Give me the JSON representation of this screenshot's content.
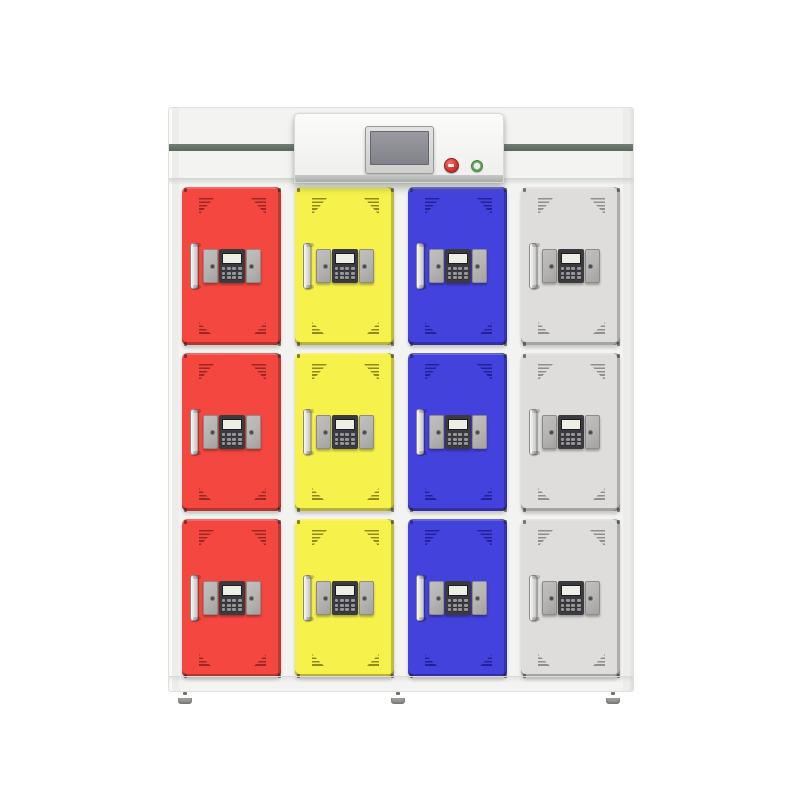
{
  "scene": {
    "description": "Smart electronic storage locker cabinet with twelve keypad-locked doors in four colors and a central touchscreen control panel"
  },
  "colors": {
    "background": "#ffffff",
    "cabinet_body": "#f3f3f1",
    "cabinet_edge": "#e0e0de",
    "stripe": "#6f7e72",
    "screen_display": "#87878d",
    "button_stop": "#d0352e",
    "button_power": "#67a25e",
    "lock_plate": "#b5b3b1",
    "lock_panel": "#3b3b3f",
    "lock_display": "#edeee4",
    "lock_key": "#97979b",
    "foot": "#9a9d99"
  },
  "cabinet": {
    "rows": 3,
    "columns": 4,
    "column_colors": [
      {
        "name": "red",
        "face": "#f4473f",
        "vent": "#9e2723"
      },
      {
        "name": "yellow",
        "face": "#f6f24b",
        "vent": "#8f8a1e"
      },
      {
        "name": "blue",
        "face": "#4442dd",
        "vent": "#23219a"
      },
      {
        "name": "white",
        "face": "#dedddb",
        "vent": "#8f8f8b"
      }
    ]
  },
  "control_panel": {
    "buttons": [
      {
        "name": "emergency-stop-button"
      },
      {
        "name": "power-button"
      }
    ]
  },
  "door_lock": {
    "keypad_rows": 3,
    "keypad_cols": 4
  }
}
